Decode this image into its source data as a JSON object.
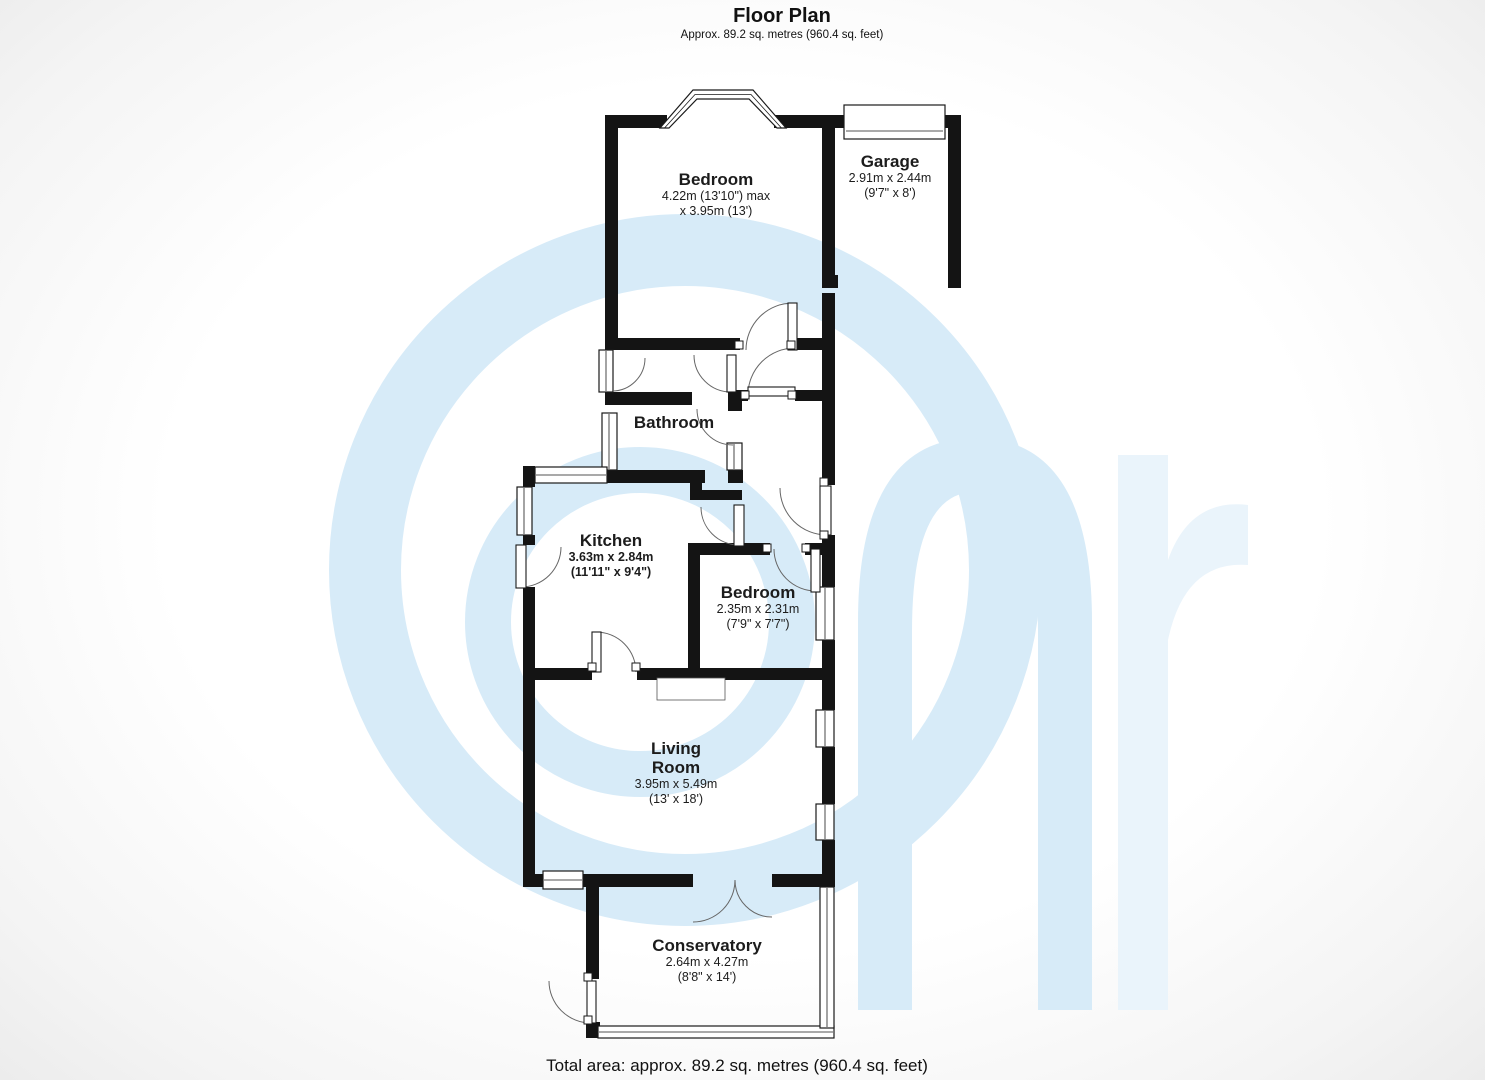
{
  "header": {
    "title": "Floor Plan",
    "subtitle": "Approx. 89.2 sq. metres (960.4 sq. feet)"
  },
  "rooms": {
    "bedroom1": {
      "name": "Bedroom",
      "dim_metric": "4.22m (13'10\") max",
      "dim_imperial": "x 3.95m (13')"
    },
    "garage": {
      "name": "Garage",
      "dim_metric": "2.91m x 2.44m",
      "dim_imperial": "(9'7\" x 8')"
    },
    "bathroom": {
      "name": "Bathroom"
    },
    "kitchen": {
      "name": "Kitchen",
      "dim_metric": "3.63m x 2.84m",
      "dim_imperial": "(11'11\" x 9'4\")"
    },
    "bedroom2": {
      "name": "Bedroom",
      "dim_metric": "2.35m x 2.31m",
      "dim_imperial": "(7'9\" x 7'7\")"
    },
    "living_room": {
      "name_line1": "Living",
      "name_line2": "Room",
      "dim_metric": "3.95m x 5.49m",
      "dim_imperial": "(13' x 18')"
    },
    "conservatory": {
      "name": "Conservatory",
      "dim_metric": "2.64m x 4.27m",
      "dim_imperial": "(8'8\" x 14')"
    }
  },
  "footer": {
    "total_area": "Total area: approx. 89.2 sq. metres (960.4 sq. feet)"
  },
  "colors": {
    "wall": "#141414",
    "watermark": "#d7ebf8",
    "watermark_light": "#eaf4fb"
  }
}
